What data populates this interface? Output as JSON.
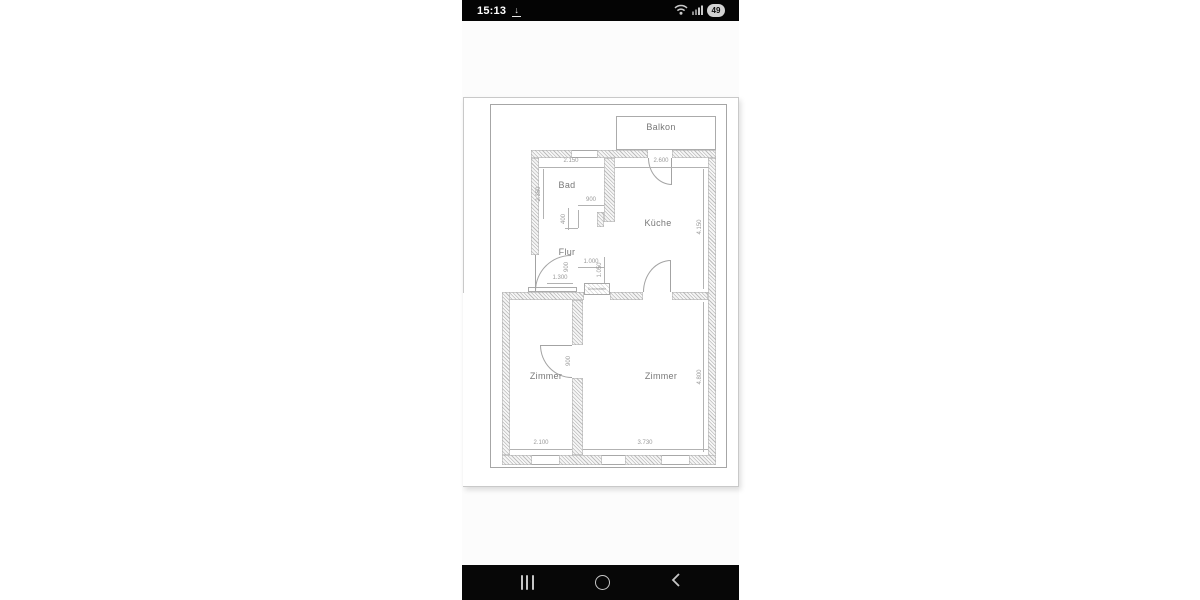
{
  "status_bar": {
    "time": "15:13",
    "battery": "49",
    "icons": {
      "download": "download-icon",
      "wifi": "wifi-icon",
      "signal": "cellular-signal-icon",
      "battery": "battery-level-badge"
    }
  },
  "nav_bar": {
    "icons": {
      "recents": "recents-icon",
      "home": "home-icon",
      "back": "back-icon"
    }
  },
  "plan": {
    "rooms": {
      "balkon": "Balkon",
      "bad": "Bad",
      "kueche": "Küche",
      "flur": "Flur",
      "zimmer_left": "Zimmer",
      "zimmer_right": "Zimmer"
    },
    "annotations": {
      "chimney": "Schornstein"
    },
    "dims": {
      "bad_w": "2.150",
      "kueche_w": "2.600",
      "bad_h": "2.350",
      "step_w": "900",
      "step_h": "400",
      "flur_w": "1.000",
      "flur_h": "1.050",
      "entry_w": "1.300",
      "door_entry": "900",
      "door_zimmer": "900",
      "kueche_h": "4.150",
      "zimmer_r_h": "4.800",
      "zimmer_l_w": "2.100",
      "zimmer_r_w": "3.730"
    }
  },
  "colors": {
    "status_bar_bg": "#040404",
    "nav_bar_bg": "#070707",
    "page_bg": "#ffffff",
    "drawing_line": "#a8a8a8",
    "label_text": "#787878"
  }
}
